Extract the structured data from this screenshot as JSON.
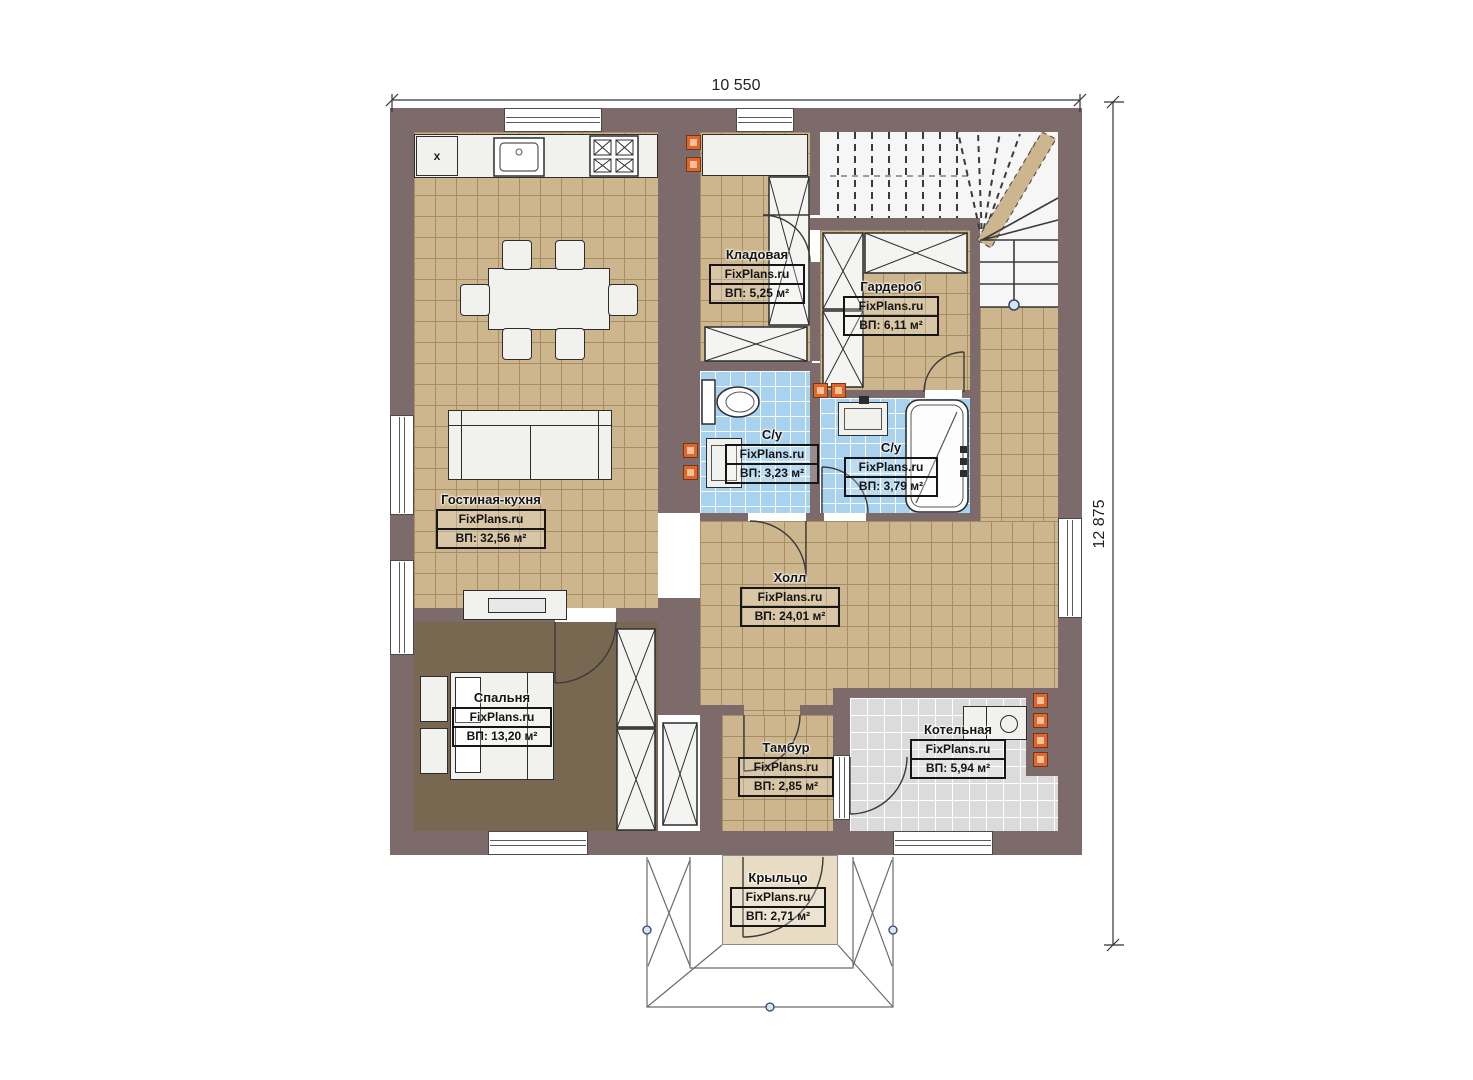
{
  "watermark": "FixPlans.ru",
  "dimensions": {
    "width_label": "10 550",
    "height_label": "12 875"
  },
  "annotations": {
    "fridge_mark": "x"
  },
  "colors": {
    "wall": "#7d6b6b",
    "floor_tan": "#cdb68d",
    "floor_blue": "#a9d2ef",
    "floor_gray": "#dbdbdb",
    "floor_bedroom": "#786852",
    "floor_porch": "#e8dcc4",
    "vent_accent": "#e2662c"
  },
  "rooms": [
    {
      "id": "storage",
      "name": "Кладовая",
      "brand": "FixPlans.ru",
      "area": "ВП: 5,25 м²"
    },
    {
      "id": "wardrobe",
      "name": "Гардероб",
      "brand": "FixPlans.ru",
      "area": "ВП: 6,11 м²"
    },
    {
      "id": "bath1",
      "name": "С/у",
      "brand": "FixPlans.ru",
      "area": "ВП: 3,23 м²"
    },
    {
      "id": "bath2",
      "name": "С/у",
      "brand": "FixPlans.ru",
      "area": "ВП: 3,79 м²"
    },
    {
      "id": "living",
      "name": "Гостиная-кухня",
      "brand": "FixPlans.ru",
      "area": "ВП: 32,56 м²"
    },
    {
      "id": "hall",
      "name": "Холл",
      "brand": "FixPlans.ru",
      "area": "ВП: 24,01 м²"
    },
    {
      "id": "bedroom",
      "name": "Спальня",
      "brand": "FixPlans.ru",
      "area": "ВП: 13,20 м²"
    },
    {
      "id": "tambour",
      "name": "Тамбур",
      "brand": "FixPlans.ru",
      "area": "ВП: 2,85 м²"
    },
    {
      "id": "boiler",
      "name": "Котельная",
      "brand": "FixPlans.ru",
      "area": "ВП: 5,94 м²"
    },
    {
      "id": "porch",
      "name": "Крыльцо",
      "brand": "FixPlans.ru",
      "area": "ВП: 2,71 м²"
    }
  ]
}
